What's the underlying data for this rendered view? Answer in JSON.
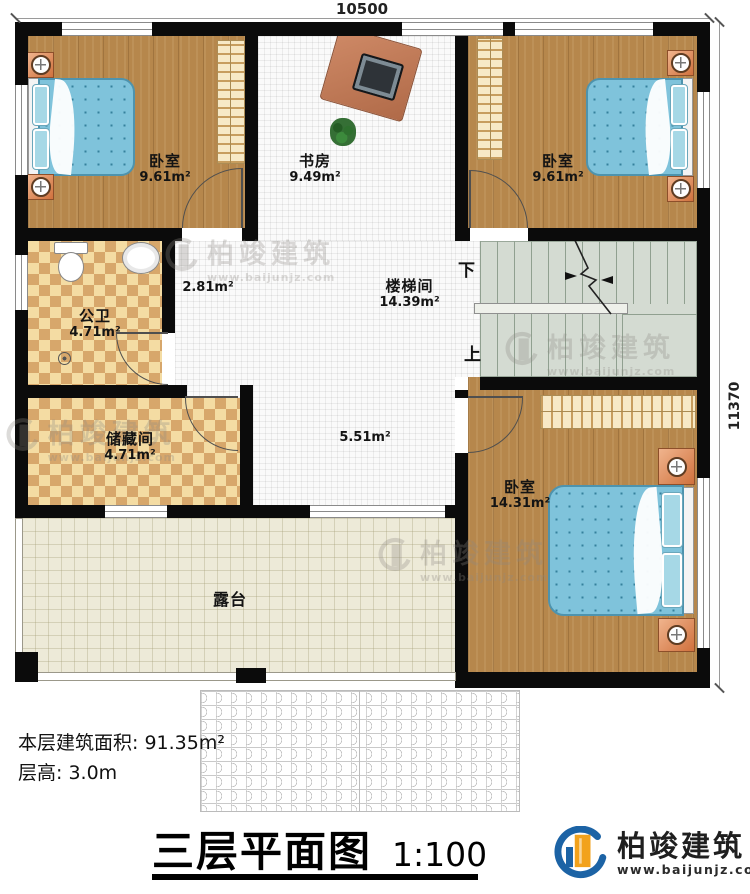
{
  "brand": {
    "name": "柏竣建筑",
    "url": "www.baijunjz.com"
  },
  "dims": {
    "width": "10500",
    "height": "11370"
  },
  "rooms": {
    "bedroom_tl": {
      "name": "卧室",
      "area": "9.61m²"
    },
    "study": {
      "name": "书房",
      "area": "9.49m²"
    },
    "bedroom_tr": {
      "name": "卧室",
      "area": "9.61m²"
    },
    "bathroom": {
      "name": "公卫",
      "area": "4.71m²"
    },
    "corridor": {
      "area": "2.81m²"
    },
    "stairwell": {
      "name": "楼梯间",
      "area": "14.39m²"
    },
    "storage": {
      "name": "储藏间",
      "area": "4.71m²"
    },
    "hall": {
      "area": "5.51m²"
    },
    "bedroom_br": {
      "name": "卧室",
      "area": "14.31m²"
    },
    "terrace": {
      "name": "露台"
    }
  },
  "stairs": {
    "down_label": "下",
    "up_label": "上"
  },
  "footer": {
    "floor_area": "本层建筑面积: 91.35m²",
    "floor_height": "层高: 3.0m",
    "title": "三层平面图",
    "scale": "1:100"
  },
  "colors": {
    "wall": "#0b0b0b",
    "wood": "#b6874c",
    "tile": "#f4dca3",
    "bed": "#7fc3db",
    "accent_blue": "#1c63a5",
    "accent_orange": "#f2a21c"
  }
}
